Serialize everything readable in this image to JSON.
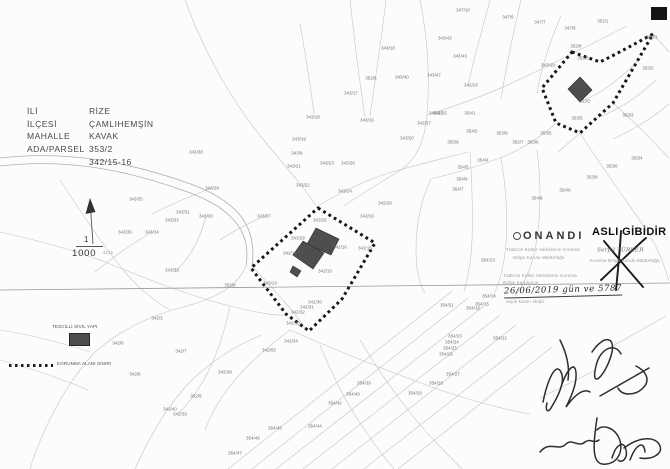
{
  "info": {
    "labels": [
      "İLİ",
      "İLÇESİ",
      "MAHALLE",
      "ADA/PARSEL"
    ],
    "values": [
      "RİZE",
      "ÇAMLIHEMŞİN",
      "KAVAK",
      "353/2",
      "342/15-16"
    ]
  },
  "scale": {
    "top": "1",
    "bottom": "1000",
    "sub": "4211"
  },
  "legend": {
    "building": "TESCİLLİ SİVİL YAPI",
    "boundary": "KORUNMA ALANI SINIRI"
  },
  "stamps": {
    "onandi": {
      "title": "ONANDI",
      "line1": "Trabzon Kültür Varlıklarını Koruma",
      "line2": "Bölge Kurulu Müdürlüğü"
    },
    "approval": {
      "line1": "Trabzon Kültür Varlıklarını Koruma",
      "line2": "Bölge Kurulunun",
      "date": "26/06/2019 gün ve 5787",
      "line3": "sayılı kararı ekidir."
    },
    "asli": {
      "title": "ASLI GİBİDİR",
      "name": "Serpil TÜRKER",
      "org": "Koruma Bölge Kurulu Müdürlüğü"
    }
  },
  "colors": {
    "building_fill": "#4e4e4e",
    "boundary": "#161616",
    "map_line": "#c4c4c4"
  },
  "parcels": [
    {
      "x": 463,
      "y": 10,
      "t": "347/10"
    },
    {
      "x": 508,
      "y": 17,
      "t": "347/9"
    },
    {
      "x": 540,
      "y": 22,
      "t": "347/7"
    },
    {
      "x": 570,
      "y": 28,
      "t": "347/8"
    },
    {
      "x": 603,
      "y": 21,
      "t": "352/1"
    },
    {
      "x": 652,
      "y": 37,
      "t": "353/1"
    },
    {
      "x": 576,
      "y": 46,
      "t": "352/8"
    },
    {
      "x": 548,
      "y": 65,
      "t": "343/19"
    },
    {
      "x": 583,
      "y": 58,
      "t": "353/8"
    },
    {
      "x": 648,
      "y": 68,
      "t": "353/2"
    },
    {
      "x": 585,
      "y": 101,
      "t": "353/2"
    },
    {
      "x": 628,
      "y": 115,
      "t": "353/3"
    },
    {
      "x": 577,
      "y": 118,
      "t": "353/5"
    },
    {
      "x": 637,
      "y": 158,
      "t": "353/4"
    },
    {
      "x": 612,
      "y": 166,
      "t": "353/6"
    },
    {
      "x": 592,
      "y": 177,
      "t": "353/8"
    },
    {
      "x": 565,
      "y": 190,
      "t": "354/6"
    },
    {
      "x": 445,
      "y": 38,
      "t": "343/42"
    },
    {
      "x": 460,
      "y": 56,
      "t": "343/43"
    },
    {
      "x": 402,
      "y": 77,
      "t": "343/40"
    },
    {
      "x": 434,
      "y": 75,
      "t": "343/47"
    },
    {
      "x": 371,
      "y": 78,
      "t": "352/6"
    },
    {
      "x": 351,
      "y": 93,
      "t": "343/17"
    },
    {
      "x": 388,
      "y": 48,
      "t": "343/18"
    },
    {
      "x": 313,
      "y": 117,
      "t": "343/18"
    },
    {
      "x": 367,
      "y": 120,
      "t": "343/19"
    },
    {
      "x": 424,
      "y": 123,
      "t": "342/27"
    },
    {
      "x": 407,
      "y": 138,
      "t": "343/20"
    },
    {
      "x": 440,
      "y": 113,
      "t": "342/25"
    },
    {
      "x": 471,
      "y": 85,
      "t": "342/29"
    },
    {
      "x": 385,
      "y": 203,
      "t": "342/28"
    },
    {
      "x": 367,
      "y": 216,
      "t": "342/19"
    },
    {
      "x": 264,
      "y": 216,
      "t": "343/27"
    },
    {
      "x": 320,
      "y": 220,
      "t": "343/25"
    },
    {
      "x": 298,
      "y": 238,
      "t": "343/29"
    },
    {
      "x": 290,
      "y": 253,
      "t": "342/14"
    },
    {
      "x": 340,
      "y": 247,
      "t": "342/16"
    },
    {
      "x": 365,
      "y": 248,
      "t": "342/15"
    },
    {
      "x": 325,
      "y": 271,
      "t": "342/10"
    },
    {
      "x": 270,
      "y": 283,
      "t": "343/13"
    },
    {
      "x": 315,
      "y": 302,
      "t": "342/30"
    },
    {
      "x": 307,
      "y": 307,
      "t": "342/31"
    },
    {
      "x": 298,
      "y": 312,
      "t": "342/32"
    },
    {
      "x": 293,
      "y": 323,
      "t": "342/33"
    },
    {
      "x": 212,
      "y": 188,
      "t": "343/28"
    },
    {
      "x": 183,
      "y": 212,
      "t": "343/31"
    },
    {
      "x": 172,
      "y": 220,
      "t": "343/32"
    },
    {
      "x": 152,
      "y": 232,
      "t": "343/34"
    },
    {
      "x": 206,
      "y": 216,
      "t": "343/30"
    },
    {
      "x": 172,
      "y": 270,
      "t": "343/33"
    },
    {
      "x": 136,
      "y": 199,
      "t": "343/35"
    },
    {
      "x": 125,
      "y": 232,
      "t": "343/36"
    },
    {
      "x": 196,
      "y": 152,
      "t": "343/38"
    },
    {
      "x": 230,
      "y": 285,
      "t": "352/9"
    },
    {
      "x": 299,
      "y": 139,
      "t": "343/19"
    },
    {
      "x": 297,
      "y": 153,
      "t": "343/8"
    },
    {
      "x": 294,
      "y": 166,
      "t": "343/21"
    },
    {
      "x": 327,
      "y": 163,
      "t": "343/23"
    },
    {
      "x": 348,
      "y": 163,
      "t": "343/26"
    },
    {
      "x": 303,
      "y": 185,
      "t": "343/22"
    },
    {
      "x": 345,
      "y": 191,
      "t": "343/24"
    },
    {
      "x": 436,
      "y": 113,
      "t": "342/47"
    },
    {
      "x": 470,
      "y": 113,
      "t": "354/1"
    },
    {
      "x": 472,
      "y": 131,
      "t": "354/2"
    },
    {
      "x": 453,
      "y": 142,
      "t": "355/9"
    },
    {
      "x": 502,
      "y": 133,
      "t": "353/9"
    },
    {
      "x": 546,
      "y": 133,
      "t": "353/5"
    },
    {
      "x": 518,
      "y": 142,
      "t": "352/7"
    },
    {
      "x": 533,
      "y": 142,
      "t": "353/6"
    },
    {
      "x": 483,
      "y": 160,
      "t": "354/4"
    },
    {
      "x": 463,
      "y": 167,
      "t": "354/5"
    },
    {
      "x": 462,
      "y": 179,
      "t": "354/8"
    },
    {
      "x": 458,
      "y": 189,
      "t": "354/7"
    },
    {
      "x": 537,
      "y": 198,
      "t": "354/9"
    },
    {
      "x": 455,
      "y": 336,
      "t": "354/23"
    },
    {
      "x": 452,
      "y": 342,
      "t": "354/24"
    },
    {
      "x": 450,
      "y": 348,
      "t": "354/25"
    },
    {
      "x": 446,
      "y": 354,
      "t": "354/26"
    },
    {
      "x": 453,
      "y": 374,
      "t": "354/27"
    },
    {
      "x": 436,
      "y": 383,
      "t": "354/28"
    },
    {
      "x": 415,
      "y": 393,
      "t": "354/29"
    },
    {
      "x": 364,
      "y": 383,
      "t": "354/39"
    },
    {
      "x": 353,
      "y": 394,
      "t": "354/40"
    },
    {
      "x": 335,
      "y": 403,
      "t": "354/42"
    },
    {
      "x": 315,
      "y": 426,
      "t": "354/44"
    },
    {
      "x": 489,
      "y": 296,
      "t": "354/14"
    },
    {
      "x": 482,
      "y": 304,
      "t": "354/15"
    },
    {
      "x": 473,
      "y": 308,
      "t": "354/18"
    },
    {
      "x": 447,
      "y": 305,
      "t": "354/21"
    },
    {
      "x": 500,
      "y": 338,
      "t": "354/22"
    },
    {
      "x": 488,
      "y": 260,
      "t": "354/13"
    },
    {
      "x": 181,
      "y": 351,
      "t": "342/7"
    },
    {
      "x": 269,
      "y": 350,
      "t": "342/55"
    },
    {
      "x": 291,
      "y": 341,
      "t": "342/34"
    },
    {
      "x": 225,
      "y": 372,
      "t": "342/38"
    },
    {
      "x": 196,
      "y": 396,
      "t": "352/9"
    },
    {
      "x": 170,
      "y": 409,
      "t": "342/40"
    },
    {
      "x": 180,
      "y": 414,
      "t": "342/39"
    },
    {
      "x": 135,
      "y": 374,
      "t": "342/8"
    },
    {
      "x": 157,
      "y": 318,
      "t": "342/3"
    },
    {
      "x": 118,
      "y": 343,
      "t": "342/6"
    },
    {
      "x": 275,
      "y": 428,
      "t": "354/45"
    },
    {
      "x": 253,
      "y": 438,
      "t": "354/46"
    },
    {
      "x": 235,
      "y": 453,
      "t": "354/47"
    }
  ]
}
